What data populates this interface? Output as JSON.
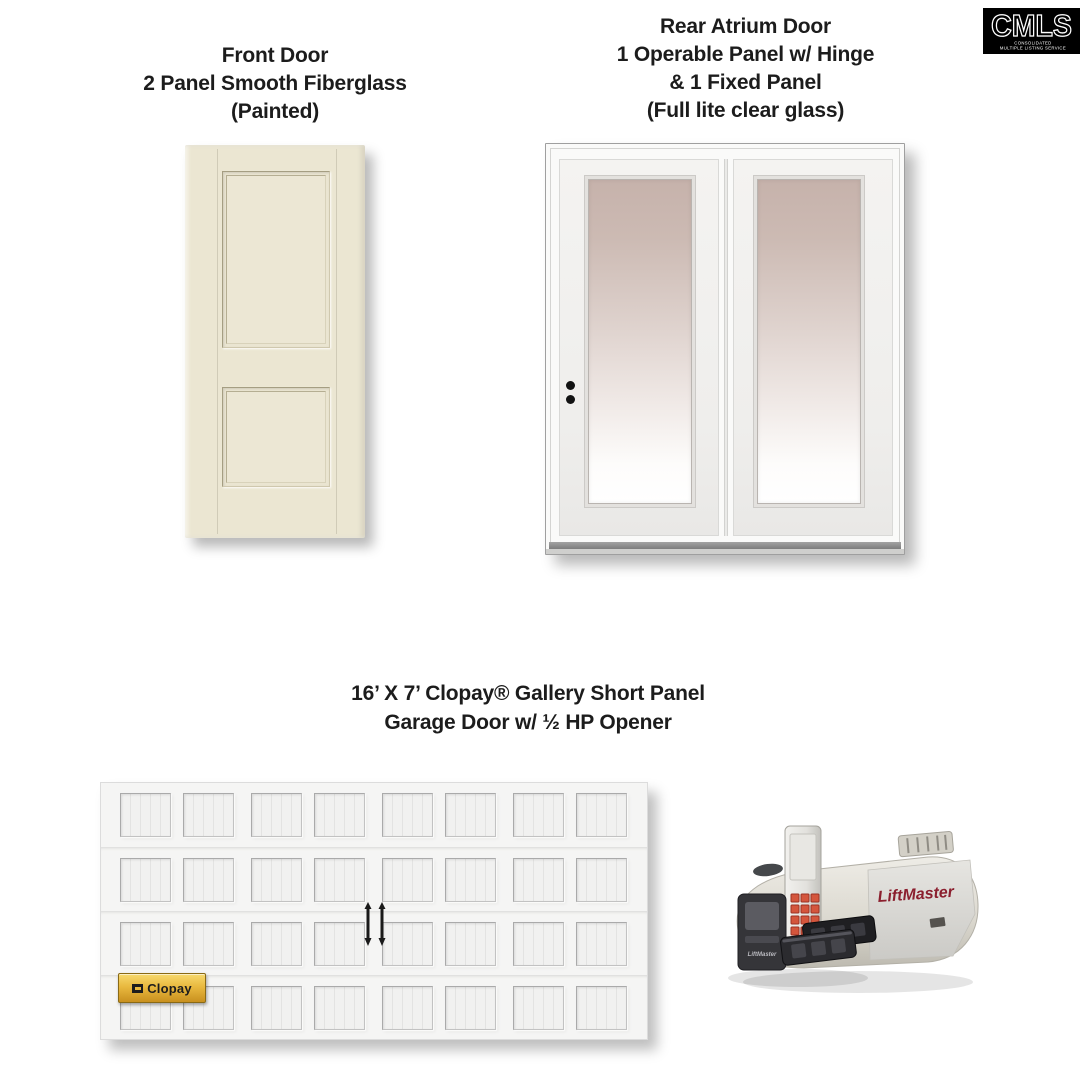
{
  "logo": {
    "brand": "CMLS",
    "subtext_line1": "CONSOLIDATED",
    "subtext_line2": "MULTIPLE LISTING SERVICE",
    "bg_color": "#000000",
    "text_color": "#ffffff"
  },
  "front_door": {
    "title_lines": [
      "Front Door",
      "2 Panel Smooth Fiberglass",
      "(Painted)"
    ],
    "door_color": "#ebe6d2"
  },
  "atrium_door": {
    "title_lines": [
      "Rear Atrium Door",
      "1 Operable Panel w/ Hinge",
      "& 1 Fixed Panel",
      "(Full lite clear glass)"
    ],
    "glass_tint_top": "#c6b2ab"
  },
  "garage": {
    "title_lines": [
      "16’ X 7’ Clopay® Gallery Short Panel",
      "Garage Door w/ ½ HP Opener"
    ],
    "panel_rows": 4,
    "panel_cols": 8,
    "badge_label": "Clopay",
    "badge_color": "#e9b93f",
    "opener_brand": "LiftMaster",
    "brand_red": "#8b1f2e"
  }
}
